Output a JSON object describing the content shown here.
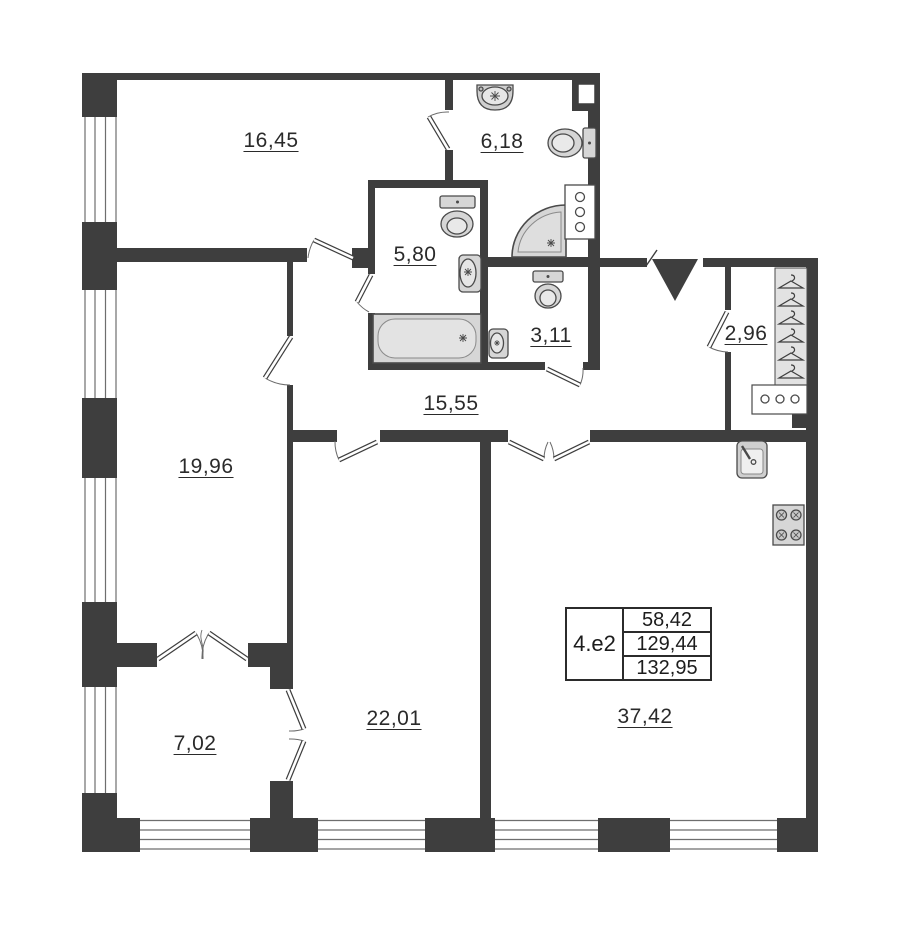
{
  "plan": {
    "areas": {
      "room_top_left": "16,45",
      "bathroom_top": "6,18",
      "bathroom_mid": "5,80",
      "wc": "3,11",
      "wardrobe": "2,96",
      "hallway": "15,55",
      "room_left": "19,96",
      "balcony": "7,02",
      "room_bottom_mid": "22,01",
      "kitchen_living": "37,42"
    },
    "info_table": {
      "unit_type": "4.e2",
      "values": [
        "58,42",
        "129,44",
        "132,95"
      ]
    },
    "colors": {
      "wall": "#3e3e3e",
      "fixture_fill": "#d6d6d6",
      "fixture_stroke": "#4a4a4a",
      "background": "#ffffff"
    },
    "icons": [
      "sink-icon",
      "toilet-icon",
      "shower-icon",
      "bathtub-icon",
      "hanger-icon",
      "drawer-unit-icon",
      "kitchen-sink-icon",
      "stove-icon",
      "entrance-arrow-icon",
      "window-icon",
      "door-icon"
    ]
  }
}
